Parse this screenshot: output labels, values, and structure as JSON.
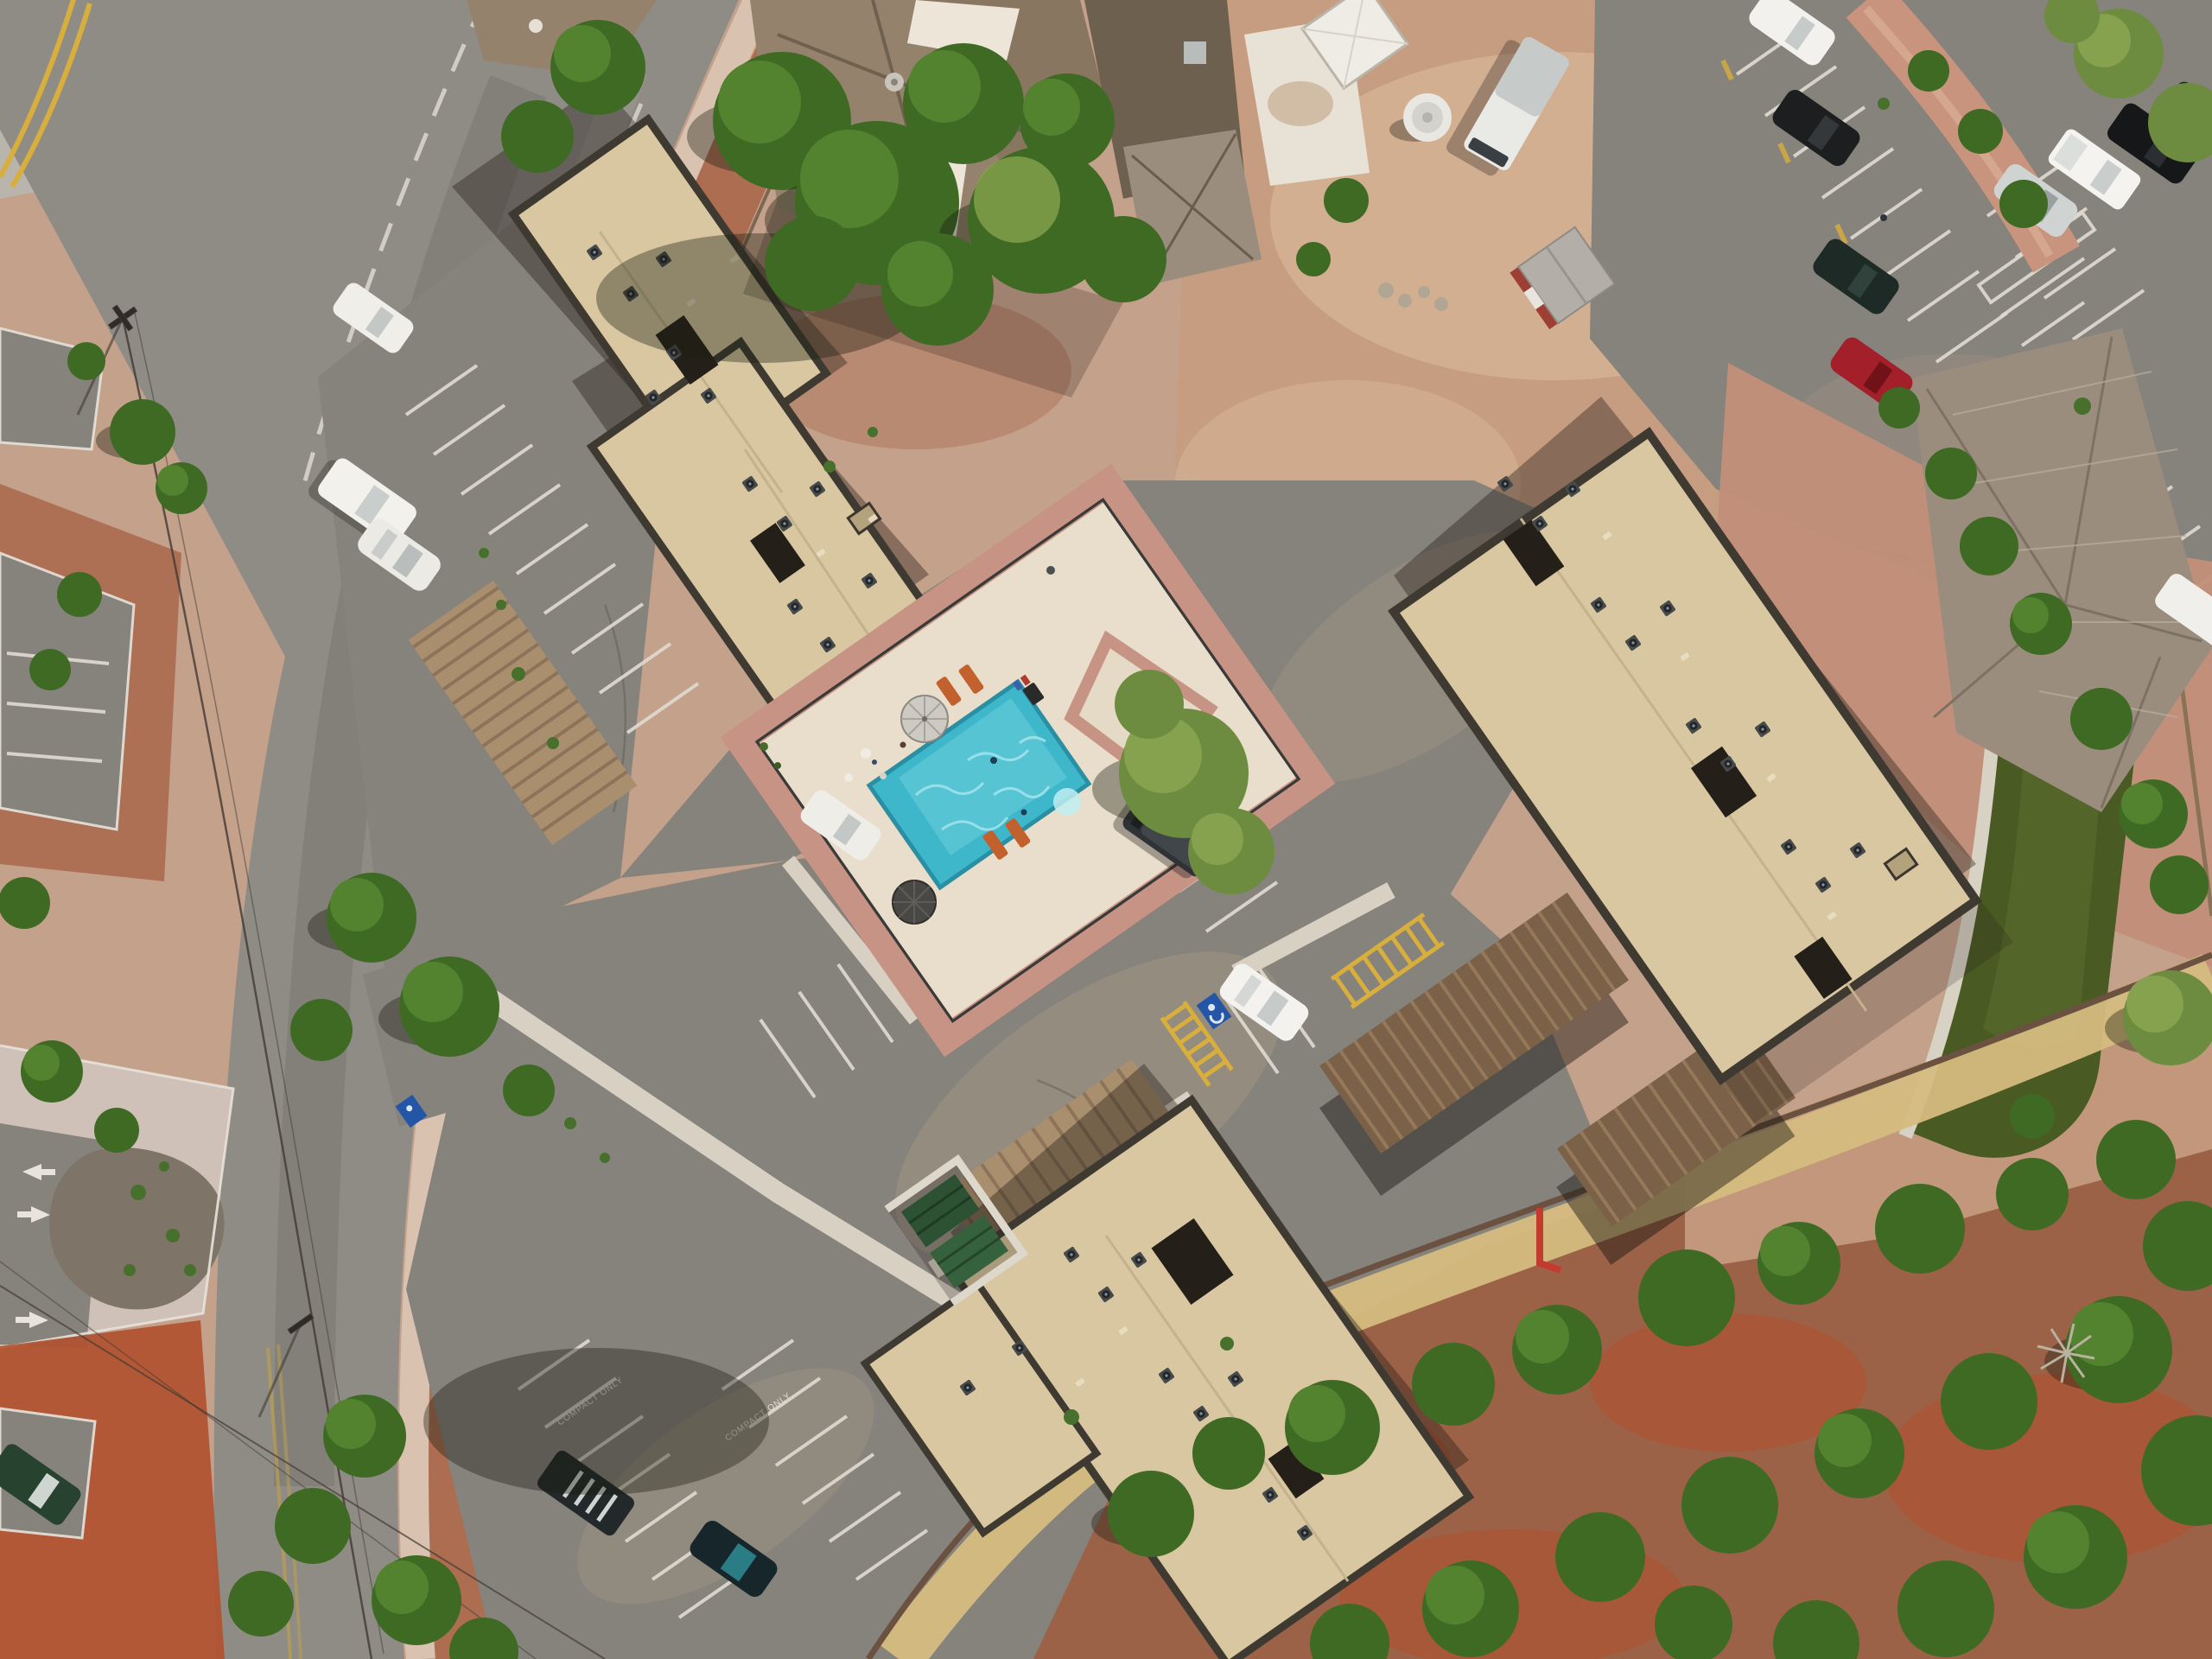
{
  "meta": {
    "title": "Aerial drone view of a condominium complex with pool"
  },
  "scene": {
    "description": "Top-down aerial photograph: three tan flat-roofed condominium buildings with dark parapets and rooftop AC units, a central turquoise swimming pool with cream deck, two umbrellas and orange loungers, brown carport rows, asphalt parking lots with white stalls and COMPACT ONLY markings, a gray two-lane road curving along the left edge with yellow center lines, red-dirt desert with green scrub trees in the lower right, a shingle-roofed house, RV, white tank, red shed and parked cars along the top, and a green lawn strip beside the right building.",
    "labels": {
      "compact_only": "COMPACT ONLY"
    },
    "palette": {
      "road_asphalt": "#8f8c86",
      "lot_asphalt": "#86827c",
      "red_dirt": "#ab6a4e",
      "tan_dirt": "#c79d81",
      "sidewalk_pink": "#d9c2b0",
      "concrete": "#cfc0b8",
      "roof_tan": "#d8c7a0",
      "roof_parapet": "#3e3a32",
      "roof_shingle_brown": "#94826d",
      "hip_roof_gray": "#9a8d7e",
      "pool_water": "#3fb7ca",
      "pool_deck": "#e8decb",
      "paver_pink": "#c79384",
      "lawn_green": "#4a5a23",
      "tree_green": "#3f6a24",
      "tree_olive": "#6d8c40",
      "dry_grass": "#d5c07f",
      "carport_brown": "#7b6148",
      "lounger_orange": "#c2602e",
      "hatch_yellow": "#d8ae3c",
      "handicap_blue": "#2456a8",
      "curb_red": "#c33b2f",
      "marking_white": "#ded9d0"
    },
    "objects": {
      "apartment_buildings": 3,
      "outbuildings": 5,
      "swimming_pools": 1,
      "pool_umbrellas": 2,
      "pool_loungers": 4,
      "carport_rows": 4,
      "parked_vehicles": 16,
      "rv_count": 1,
      "dumpsters": 2,
      "painted_arrows": 3,
      "handicap_stalls": 2,
      "power_poles": 2
    }
  }
}
